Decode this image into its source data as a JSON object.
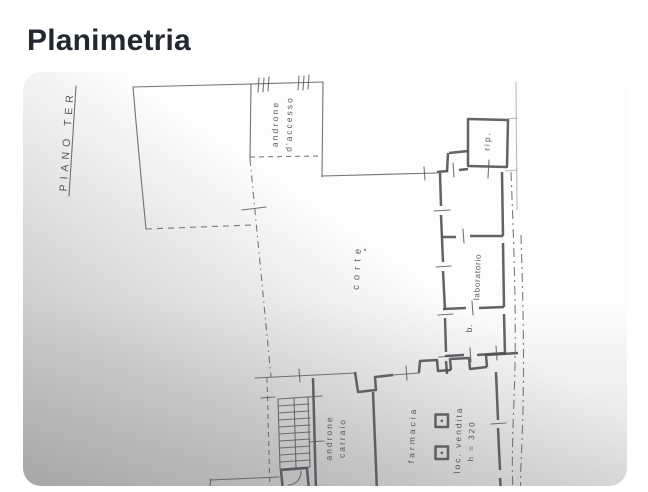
{
  "page": {
    "title": "Planimetria",
    "heading_color": "#232830",
    "background": "#ffffff"
  },
  "floorplan": {
    "kind": "scanned-floor-plan-photo",
    "ink_color": "#55565b",
    "paper_top_color": "#ffffff",
    "paper_bottom_left_color": "#a8a8a8",
    "labels": [
      {
        "id": "piano-terra",
        "text": "PIANO TER",
        "x": 70,
        "y": 141,
        "rotate": -86,
        "size": 10.5,
        "spacing": 5,
        "underline": true
      },
      {
        "id": "androne-accesso-1",
        "text": "androne",
        "x": 278,
        "y": 124,
        "rotate": -89,
        "size": 8.5,
        "spacing": 2.2
      },
      {
        "id": "androne-accesso-2",
        "text": "d'accesso",
        "x": 292,
        "y": 124,
        "rotate": -89,
        "size": 8.5,
        "spacing": 2
      },
      {
        "id": "ripostiglio",
        "text": "rip.",
        "x": 490,
        "y": 141,
        "rotate": -89,
        "size": 8.5,
        "spacing": 2
      },
      {
        "id": "corte",
        "text": "corte",
        "x": 360,
        "y": 267,
        "rotate": -87,
        "size": 9.5,
        "spacing": 5
      },
      {
        "id": "laboratorio",
        "text": "laboratorio",
        "x": 480,
        "y": 277,
        "rotate": -88,
        "size": 8,
        "spacing": 0.8
      },
      {
        "id": "bagno",
        "text": "b.",
        "x": 472,
        "y": 328,
        "rotate": -88,
        "size": 8.5,
        "spacing": 1
      },
      {
        "id": "androne-carraio-1",
        "text": "androne",
        "x": 332,
        "y": 438,
        "rotate": -89,
        "size": 8.5,
        "spacing": 2
      },
      {
        "id": "androne-carraio-2",
        "text": "carraio",
        "x": 345,
        "y": 438,
        "rotate": -89,
        "size": 8.5,
        "spacing": 2
      },
      {
        "id": "farmacia",
        "text": "farmacia",
        "x": 415,
        "y": 435,
        "rotate": -88,
        "size": 8.5,
        "spacing": 3
      },
      {
        "id": "locale-vendita",
        "text": "loc. vendita",
        "x": 461,
        "y": 440,
        "rotate": -88,
        "size": 8.5,
        "spacing": 2
      },
      {
        "id": "altezza",
        "text": "h = 320",
        "x": 474,
        "y": 441,
        "rotate": -88,
        "size": 8,
        "spacing": 2
      }
    ]
  }
}
